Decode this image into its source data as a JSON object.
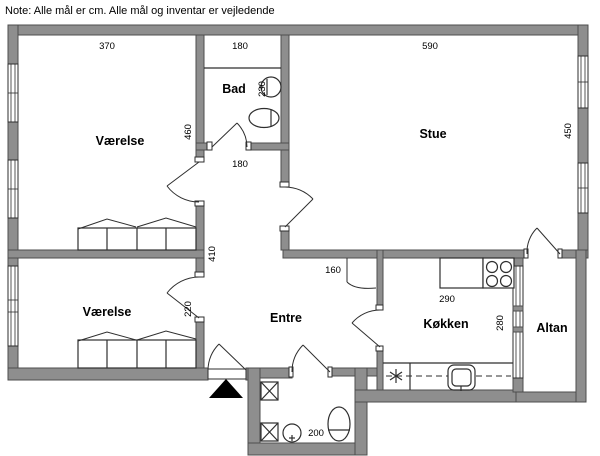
{
  "note": "Note: Alle mål er cm. Alle mål og inventar er vejledende",
  "rooms": {
    "bedroom_top": "Værelse",
    "bedroom_bottom": "Værelse",
    "bathroom": "Bad",
    "living_room": "Stue",
    "hallway": "Entre",
    "kitchen": "Køkken",
    "balcony": "Altan"
  },
  "dimensions_cm": {
    "bedroom_top_width": "370",
    "bathroom_width_top": "180",
    "living_room_width": "590",
    "bedroom_top_depth": "460",
    "bathroom_depth": "230",
    "living_room_depth": "450",
    "bathroom_width_bottom": "180",
    "hallway_length": "410",
    "hallway_nook_width": "160",
    "kitchen_width": "290",
    "bedroom_bottom_depth": "220",
    "kitchen_depth": "280",
    "wc_width": "200"
  },
  "colors": {
    "wall": "#8e8e8e",
    "wall_edge": "#4d4d4d",
    "line": "#2e2e2e",
    "background": "#ffffff"
  }
}
